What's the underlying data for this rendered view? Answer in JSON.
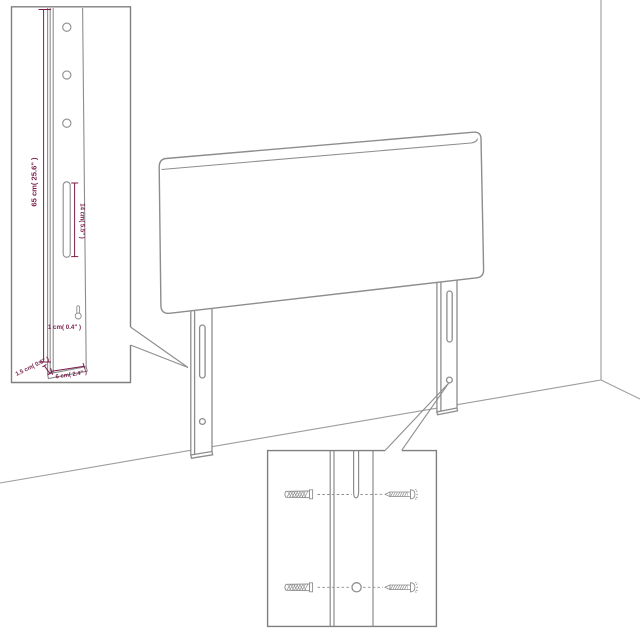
{
  "colors": {
    "background": "#ffffff",
    "product_outline": "#8d8d8d",
    "room_line": "#9c9c9c",
    "inset_border": "#7f7f7f",
    "measurement": "#7a1d4a"
  },
  "leg_detail_inset": {
    "height_label": "65 cm( 25.6\" )",
    "slot_label": "14 cm( 5.5\" )",
    "keyhole_label": "1 cm( 0.4\" )",
    "side_thickness_label": "1.5 cm( 0.6\" )",
    "bottom_width_label": "6 cm( 2.4\" )"
  }
}
